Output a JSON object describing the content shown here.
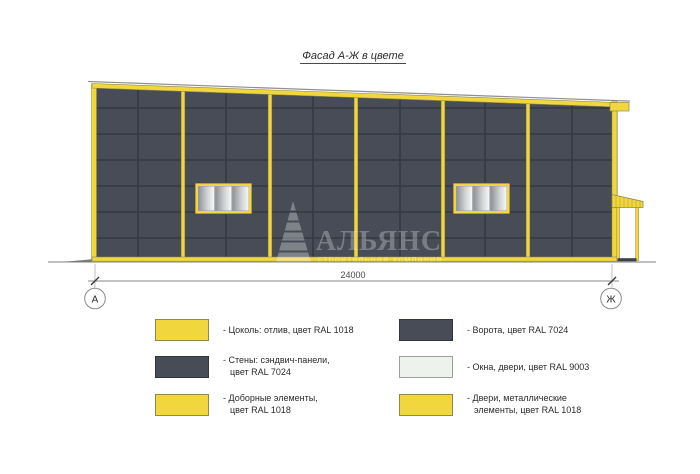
{
  "title": "Фасад А-Ж в цвете",
  "drawing": {
    "dimension_value": "24000",
    "axis_left_label": "А",
    "axis_right_label": "Ж",
    "watermark": {
      "company": "АЛЬЯНС",
      "tagline": "строительная компания"
    }
  },
  "colors": {
    "accent_yellow_ral1018": "#f2d63e",
    "wall_gray_ral7024": "#474c57",
    "window_white_ral9003": "#eef2ec",
    "panel_joint": "#343943"
  },
  "legend": {
    "items": [
      {
        "swatch_color": "#f2d63e",
        "lines": [
          "- Цоколь: отлив, цвет RAL 1018",
          ""
        ]
      },
      {
        "swatch_color": "#474c57",
        "lines": [
          "- Стены: сэндвич-панели,",
          "цвет RAL 7024"
        ]
      },
      {
        "swatch_color": "#f2d63e",
        "lines": [
          "- Доборные элементы,",
          "цвет RAL 1018"
        ]
      },
      {
        "swatch_color": "#474c57",
        "lines": [
          "- Ворота, цвет RAL 7024",
          ""
        ]
      },
      {
        "swatch_color": "#eef2ec",
        "lines": [
          "- Окна, двери, цвет RAL 9003",
          ""
        ]
      },
      {
        "swatch_color": "#f2d63e",
        "lines": [
          "- Двери, металлические",
          "элементы, цвет RAL 1018"
        ]
      }
    ]
  }
}
